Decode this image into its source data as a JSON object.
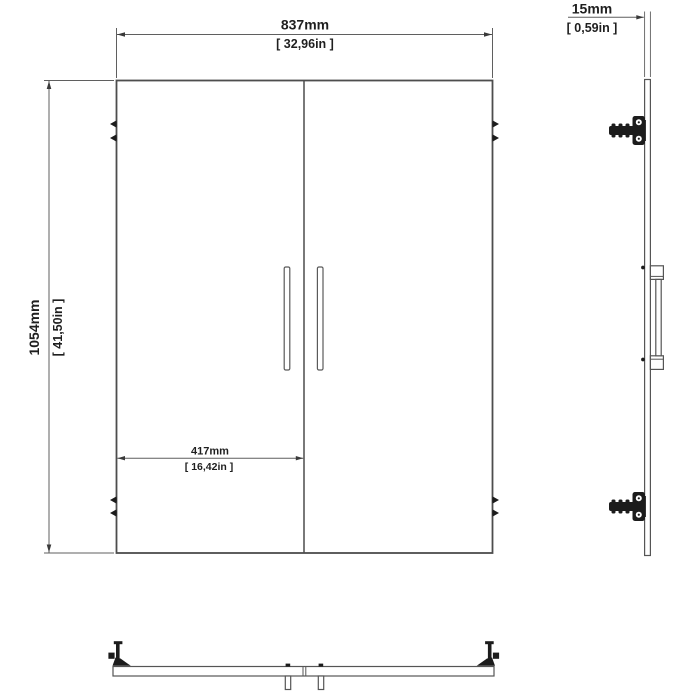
{
  "drawing": {
    "type": "technical-dimension-drawing",
    "subject": "double cabinet doors with hinges and handles",
    "views": {
      "front": "front-view",
      "side": "side-profile-view",
      "bottom": "bottom-plan-view"
    },
    "dimensions": {
      "overall_width": {
        "metric": "837mm",
        "imperial": "[ 32,96in ]"
      },
      "overall_height": {
        "metric": "1054mm",
        "imperial": "[ 41,50in ]"
      },
      "single_door_width": {
        "metric": "417mm",
        "imperial": "[ 16,42in ]"
      },
      "panel_thickness": {
        "metric": "15mm",
        "imperial": "[ 0,59in ]"
      }
    },
    "colors": {
      "background": "#ffffff",
      "outline": "#4d4d4d",
      "dimension_line": "#5f5f5f",
      "text": "#1f1f1f",
      "hardware": "#1c1c1c"
    }
  }
}
